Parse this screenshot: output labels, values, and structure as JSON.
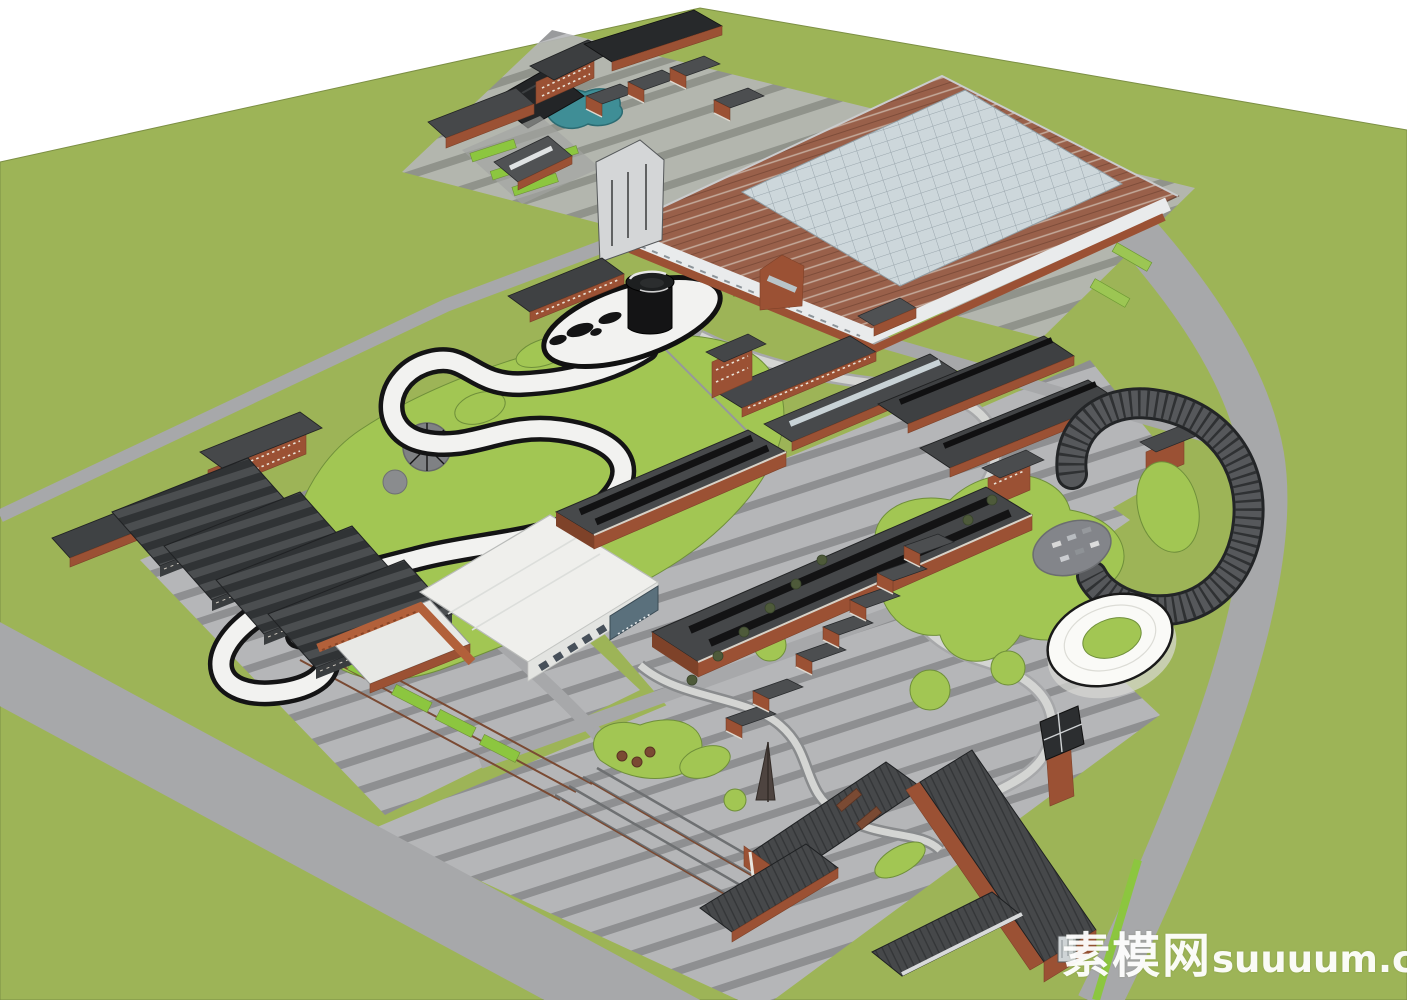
{
  "meta": {
    "description": "Aerial 3D master-plan rendering of an industrial heritage park (SketchUp style)"
  },
  "watermark": {
    "cn": "素模网",
    "en": "suuuum.com"
  },
  "scene": {
    "colors": {
      "grass": "#9db457",
      "lawn": "#a2c653",
      "lawn_bright": "#8cc63f",
      "lawn_edge": "#6f8f3a",
      "road": "#a7a8aa",
      "pave": "#b5b6b8",
      "pave_dark": "#8e8f91",
      "roof": "#505254",
      "roof_dark": "#3a3d3f",
      "roof_black": "#1d1f20",
      "ink": "#141415",
      "brick": "#9b5134",
      "brick_dark": "#7e4229",
      "terracotta": "#99604a",
      "glass": "#cdd7db",
      "white_bldg": "#efefec",
      "ring": "#fafaf7",
      "ramp": "#56585b",
      "ramp_edge": "#232527",
      "pond": "#3f8e96",
      "rail": "#6e7072",
      "rust": "#7a4a33",
      "path_white": "#f2f2f0",
      "watermark": "#ffffff"
    },
    "landmarks": [
      {
        "id": "glass-roof-factory",
        "label": "large sawtooth factory with glass roof"
      },
      {
        "id": "black-spiral-tower",
        "label": "black spiral observation tower"
      },
      {
        "id": "s-curve-skywalk",
        "label": "white S-shaped elevated walkway"
      },
      {
        "id": "white-exhibition-hall",
        "label": "white curved-roof exhibition hall"
      },
      {
        "id": "long-workshop-halls",
        "label": "long dark-roof workshop halls"
      },
      {
        "id": "warehouse-rows",
        "label": "sawtooth warehouse rows"
      },
      {
        "id": "spiral-ramp",
        "label": "dark stepped spiral ramp"
      },
      {
        "id": "white-ring-pavilion",
        "label": "white ring pavilion"
      },
      {
        "id": "clock-tower",
        "label": "brick clock tower"
      },
      {
        "id": "teal-pond",
        "label": "teal pond"
      },
      {
        "id": "railway-sidings",
        "label": "railway sidings"
      }
    ]
  }
}
